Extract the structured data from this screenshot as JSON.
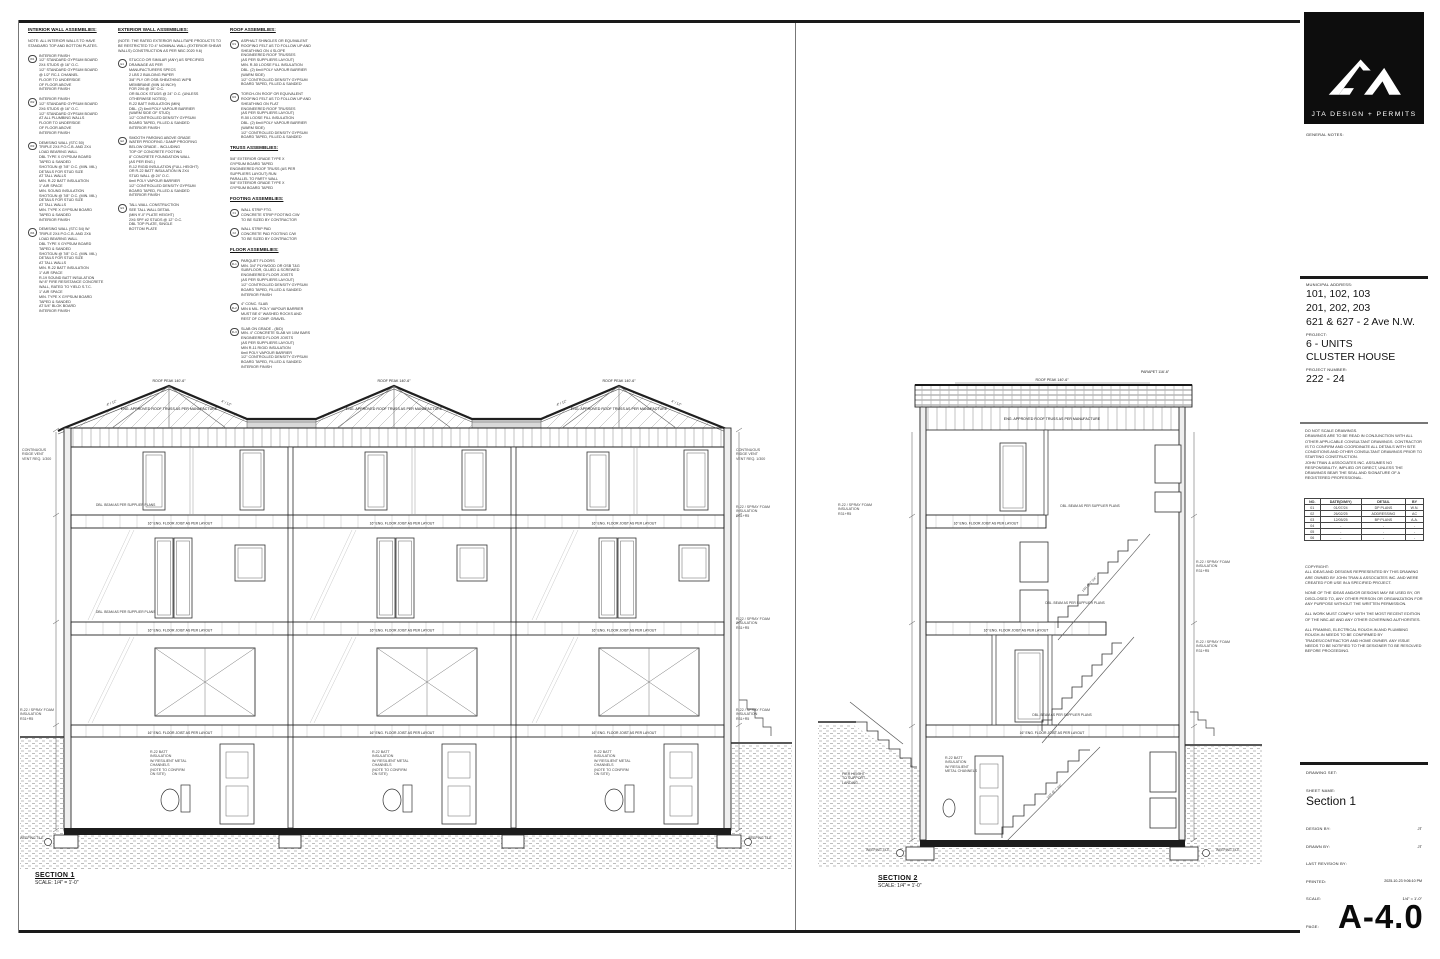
{
  "titleblock": {
    "logo_text": "JTA DESIGN + PERMITS",
    "general_notes_label": "GENERAL NOTES:",
    "municipal_address_label": "MUNICIPAL ADDRESS:",
    "address_line1": "101, 102, 103",
    "address_line2": "201, 202, 203",
    "address_line3": "621 & 627 - 2 Ave N.W.",
    "project_label": "PROJECT:",
    "project_line1": "6 - UNITS",
    "project_line2": "CLUSTER HOUSE",
    "project_number_label": "PROJECT NUMBER:",
    "project_number": "222 - 24",
    "disclaimer": "DO NOT SCALE DRAWINGS.\nDRAWINGS ARE TO BE READ IN CONJUNCTION WITH ALL OTHER APPLICABLE CONSULTANT DRAWINGS. CONTRACTOR IS TO CONFIRM AND COORDINATE ALL DETAILS WITH SITE CONDITIONS AND OTHER CONSULTANT DRAWINGS PRIOR TO STARTING CONSTRUCTION.\nJOHN TRAN & ASSOCIATES INC. ASSUMES NO RESPONSIBILITY, IMPLIED OR DIRECT, UNLESS THE DRAWINGS BEAR THE SEAL AND SIGNATURE OF A REGISTERED PROFESSIONAL.",
    "revision_table": {
      "headers": [
        "NO.",
        "DATE(D/M/Y)",
        "DETAIL",
        "BY"
      ],
      "rows": [
        {
          "no": "01",
          "date": "01/07/24",
          "detail": "DP PLANS",
          "by": "W.N."
        },
        {
          "no": "02",
          "date": "26/02/25",
          "detail": "ADDRESSING",
          "by": "AC"
        },
        {
          "no": "03",
          "date": "12/05/25",
          "detail": "BP PLANS",
          "by": "A.A."
        },
        {
          "no": "04",
          "date": "-",
          "detail": "-",
          "by": "-"
        },
        {
          "no": "05",
          "date": "-",
          "detail": "-",
          "by": "-"
        },
        {
          "no": "06",
          "date": "-",
          "detail": "-",
          "by": "-"
        }
      ]
    },
    "copyright": "COPYRIGHT:\nALL IDEAS AND DESIGNS REPRESENTED BY THIS DRAWING ARE OWNED BY JOHN TRAN & ASSOCIATES INC. AND WERE CREATED FOR USE IN A SPECIFIED PROJECT.\n\nNONE OF THE IDEAS AND/OR DESIGNS MAY BE USED BY, OR DISCLOSED TO, ANY OTHER PERSON OR ORGANIZATION FOR ANY PURPOSE WITHOUT THE WRITTEN PERMISSION.\n\nALL WORK MUST COMPLY WITH THE MOST RECENT EDITION OF THE NBC-AE AND ANY OTHER GOVERNING AUTHORITIES.\n\nALL FRAMING, ELECTRICAL ROUGH-IN AND PLUMBING ROUGH-IN NEEDS TO BE CONFIRMED BY TRADES/CONTRACTOR AND HOME OWNER. ANY ISSUE NEEDS TO BE NOTIFIED TO THE DESIGNER TO BE RESOLVED BEFORE PROCEEDING.",
    "drawing_set_label": "DRAWING SET:",
    "sheet_name_label": "SHEET NAME:",
    "sheet_name": "Section 1",
    "design_by_label": "DESIGN BY:",
    "design_by": "JT",
    "drawn_by_label": "DRAWN BY:",
    "drawn_by": "JT",
    "last_revision_label": "LAST REVISION BY:",
    "printed_label": "PRINTED:",
    "printed": "2025-10-23 9:06:10 PM",
    "scale_label": "SCALE:",
    "scale": "1/4\" = 1'-0\"",
    "page_label": "PAGE:",
    "page": "A-4.0"
  },
  "notes": {
    "col1": [
      {
        "head": "INTERIOR WALL ASSEMBLIES:",
        "marker": "",
        "text": ""
      },
      {
        "head": "",
        "marker": "",
        "text": "NOTE: ALL INTERIOR WALLS TO HAVE STANDARD TOP AND BOTTOM PLATES."
      },
      {
        "head": "",
        "marker": "W1",
        "text": "INTERIOR FINISH\n1/2\" STANDARD GYPSUM BOARD\n2X4 STUDS @ 16\" O.C.\n1/2\" STANDARD GYPSUM BOARD\n@ 1/2\" RC-1 CHANNEL\nFLOOR TO UNDERSIDE\nOF FLOOR ABOVE\nINTERIOR FINISH"
      },
      {
        "head": "",
        "marker": "W2",
        "text": "INTERIOR FINISH\n1/2\" STANDARD GYPSUM BOARD\n2X6 STUDS @ 16\" O.C.\n1/2\" STANDARD GYPSUM BOARD\nAT ALL PLUMBING WALLS\nFLOOR TO UNDERSIDE\nOF FLOOR ABOVE\nINTERIOR FINISH"
      },
      {
        "head": "",
        "marker": "W3",
        "text": "DEMISING WALL (STC 50)\nTRIPLE 2X4 P.O.C.B. AND 2X4\nLOAD BEARING WALL\nDBL TYPE X GYPSUM BOARD\nTAPED & SANDED\nSHOTGUN @ 7/8\" O.C. (MIN. MIL)\nDETAILS FOR STUD SIZE\nAT TALL WALLS\nMIN. R-22 BATT INSULATION\n1\" AIR SPACE\nMIN. SOUND INSULATION\nSHOTGUN @ 7/8\" O.C. (MIN. MIL)\nDETAILS FOR STUD SIZE\nAT TALL WALLS\nMIN. TYPE X GYPSUM BOARD\nTAPED & SANDED\nINTERIOR FINISH"
      },
      {
        "head": "",
        "marker": "W4",
        "text": "DEMISING WALL (STC 54) W/\nTRIPLE 2X4 P.O.C.B. AND 2X6\nLOAD BEARING WALL\nDBL TYPE X GYPSUM BOARD\nTAPED & SANDED\nSHOTGUN @ 7/8\" O.C. (MIN. MIL)\nDETAILS FOR STUD SIZE\nAT TALL WALLS\nMIN. R-22 BATT INSULATION\n1\" AIR SPACE\nR-19 SOUND BATT INSULATION\nW/ 8\" FIRE RESISTANCE CONCRETE\nWALL, RATED TO YIELD S.T.C.\n1\" AIR SPACE\nMIN. TYPE X GYPSUM BOARD\nTAPED & SANDED\nAT 5/4\" BLOK BOARD\nINTERIOR FINISH"
      }
    ],
    "col2": [
      {
        "head": "EXTERIOR WALL ASSEMBLIES:",
        "marker": "",
        "text": ""
      },
      {
        "head": "",
        "marker": "",
        "text": "(NOTE: THE RATED EXTERIOR WALL/TAPE PRODUCTS TO BE RESTRICTED TO 4\" NOMINAL WALL (EXTERIOR SHEAR WALLS) CONSTRUCTION AS PER NBC 2020 9.6)"
      },
      {
        "head": "",
        "marker": "E1",
        "text": "STUCCO OR SIMILAR (ANY) AS SPECIFIED\nDRAINAGE AS PER\nMANUFACTURERS SPECS\n2 LBS 2 BUILDING PAPER\n3/8\" PLY OR OSB SHEATHING W/PB\nMEMBRANE (MIN 16 INCH)\nFOR 2X6 @ 16\" O.C.\nOR BLOCK STUDS @ 24\" O.C. (UNLESS\nOTHERWISE NOTED)\nR-22 BATT INSULATION (MIN)\nDBL. (2) 6mil POLY VAPOUR BARRIER\n(WARM SIDE OF STUD)\n1/2\" CONTROLLED DENSITY GYPSUM\nBOARD TAPED, FILLED & SANDED\nINTERIOR FINISH"
      },
      {
        "head": "",
        "marker": "E2",
        "text": "SMOOTH PARGING ABOVE GRADE\nWATER PROOFING / DAMP PROOFING\nBELOW GRADE - INCLUDING\nTOP OF CONCRETE FOOTING\n8\" CONCRETE FOUNDATION WALL\n(AS PER ENG.)\nR-12 RIGID INSULATION (FULL HEIGHT)\nOR R-22 BATT INSULATION IN 2X4\nSTUD WALL @ 24\" O.C.\n6mil POLY VAPOUR BARRIER\n1/2\" CONTROLLED DENSITY GYPSUM\nBOARD TAPED, FILLED & SANDED\nINTERIOR FINISH"
      },
      {
        "head": "",
        "marker": "E3",
        "text": "TALL WALL CONSTRUCTION\nSEE TALL WALL DETAIL\n(MIN 9'-0\" PLATE HEIGHT)\n2X6 SPF #2 STUDS @ 12\" O.C.\nDBL TOP PLATE, SINGLE\nBOTTOM PLATE"
      }
    ],
    "col3": [
      {
        "head": "ROOF ASSEMBLIES:",
        "marker": "",
        "text": ""
      },
      {
        "head": "",
        "marker": "R1",
        "text": "ASPHALT SHINGLES OR EQUIVALENT\nROOFING FELT AS TO FOLLOW UP AND\nSHEATHING ON 4 SLOPE\nENGINEERED ROOF TRUSSES\n(AS PER SUPPLIERS LAYOUT)\nMIN. R-50 LOOSE FILL INSULATION\nDBL. (2) 6mil POLY VAPOUR BARRIER\n(WARM SIDE)\n1/2\" CONTROLLED DENSITY GYPSUM\nBOARD TAPED, FILLED & SANDED"
      },
      {
        "head": "",
        "marker": "R2",
        "text": "TORCH-ON ROOF OR EQUIVALENT\nROOFING FELT AS TO FOLLOW UP AND\nSHEATHING ON FLAT\nENGINEERED ROOF TRUSSES\n(AS PER SUPPLIERS LAYOUT)\nR-50 LOOSE FILL INSULATION\nDBL. (2) 6mil POLY VAPOUR BARRIER\n(WARM SIDE)\n1/2\" CONTROLLED DENSITY GYPSUM\nBOARD TAPED, FILLED & SANDED"
      },
      {
        "head": "TRUSS ASSEMBLIES:",
        "marker": "",
        "text": ""
      },
      {
        "head": "",
        "marker": "",
        "text": "5/8\" EXTERIOR GRADE TYPE X\nGYPSUM BOARD TAPED\nENGINEERED ROOF TRUSS (AS PER\nSUPPLIERS LAYOUT) RUN\nPARALLEL TO PARTY WALL\n5/8\" EXTERIOR GRADE TYPE X\nGYPSUM BOARD TAPED"
      },
      {
        "head": "FOOTING ASSEMBLIES:",
        "marker": "",
        "text": ""
      },
      {
        "head": "",
        "marker": "F1",
        "text": "WALL STRIP FTG.\nCONCRETE STRIP FOOTING C/W\nTO BE SIZED BY CONTRACTOR"
      },
      {
        "head": "",
        "marker": "F2",
        "text": "WALL STRIP PAD\nCONCRETE PAD FOOTING C/W\nTO BE SIZED BY CONTRACTOR"
      },
      {
        "head": "FLOOR ASSEMBLIES:",
        "marker": "",
        "text": ""
      },
      {
        "head": "",
        "marker": "FL1",
        "text": "PARQUET FLOORS\nMIN. 3/4\" PLYWOOD OR OSB T&G\nSUBFLOOR, GLUED & SCREWED\nENGINEERED FLOOR JOISTS\n(AS PER SUPPLIERS LAYOUT)\n1/2\" CONTROLLED DENSITY GYPSUM\nBOARD TAPED, FILLED & SANDED\nINTERIOR FINISH"
      },
      {
        "head": "",
        "marker": "FL2",
        "text": "4\" CONC. SLAB\nMIN 6 MIL. POLY VAPOUR BARRIER\nMUST BE 6\" WASHED ROCKS AND\nREST OF COMP. GRAVEL"
      },
      {
        "head": "",
        "marker": "FL3",
        "text": "SLAB ON GRADE - (B/D)\nMIN. 4\" CONCRETE SLAB W/ 10M BARS\nENGINEERED FLOOR JOISTS\n(AS PER SUPPLIERS LAYOUT)\nMIN R-11 RIGID INSULATION\n6mil POLY VAPOUR BARRIER\n1/2\" CONTROLLED DENSITY GYPSUM\nBOARD TAPED, FILLED & SANDED\nINTERIOR FINISH"
      }
    ]
  },
  "s1": {
    "title": "SECTION 1",
    "scale_text": "SCALE: 1/4\" = 1'-0\"",
    "roof_peak": "ROOF PEAK 140'-6\"",
    "slope": "4\" / 12\"",
    "truss": "ENG. APPROVED ROOF TRUSS AS PER MANUFACTURE",
    "floor_joist": "16\" ENG. FLOOR JOIST AS PER LAYOUT",
    "beam": "DBL. BEAM AS PER SUPPLIER PLANS",
    "vent_note": "CONTINUOUS\nRIDGE VENT\nVENT REQ. 1/300",
    "spray": "R-22 / SPRAY FOAM\nINSULATION\nR31+R5",
    "weep": "WEEPING TILE",
    "bsmt_note": "R-22 BATT\nINSULATION\nW/ RESILIENT METAL\nCHANNELS\n(NOTE TO CONFIRM\nON SITE)"
  },
  "s2": {
    "title": "SECTION 2",
    "scale_text": "SCALE: 1/4\" = 1'-0\"",
    "roof_peak": "ROOF PEAK 140'-6\"",
    "parapet": "PARAPET 116'-6\"",
    "truss": "ENG. APPROVED ROOF TRUSS AS PER MANUFACTURE",
    "floor_joist": "16\" ENG. FLOOR JOIST AS PER LAYOUT",
    "beam": "DBL. BEAM AS PER SUPPLIER PLANS",
    "stair_note": "14R @ 7 3/4\"",
    "spray": "R-22 / SPRAY FOAM\nINSULATION\nR31+R5",
    "landing_note": "PIER HEIGHT\nTO SUPPORT\nLANDING",
    "weep": "WEEPING TILE",
    "bsmt_note": "R-22 BATT\nINSULATION\nW/ RESILIENT\nMETAL CHANNELS"
  }
}
